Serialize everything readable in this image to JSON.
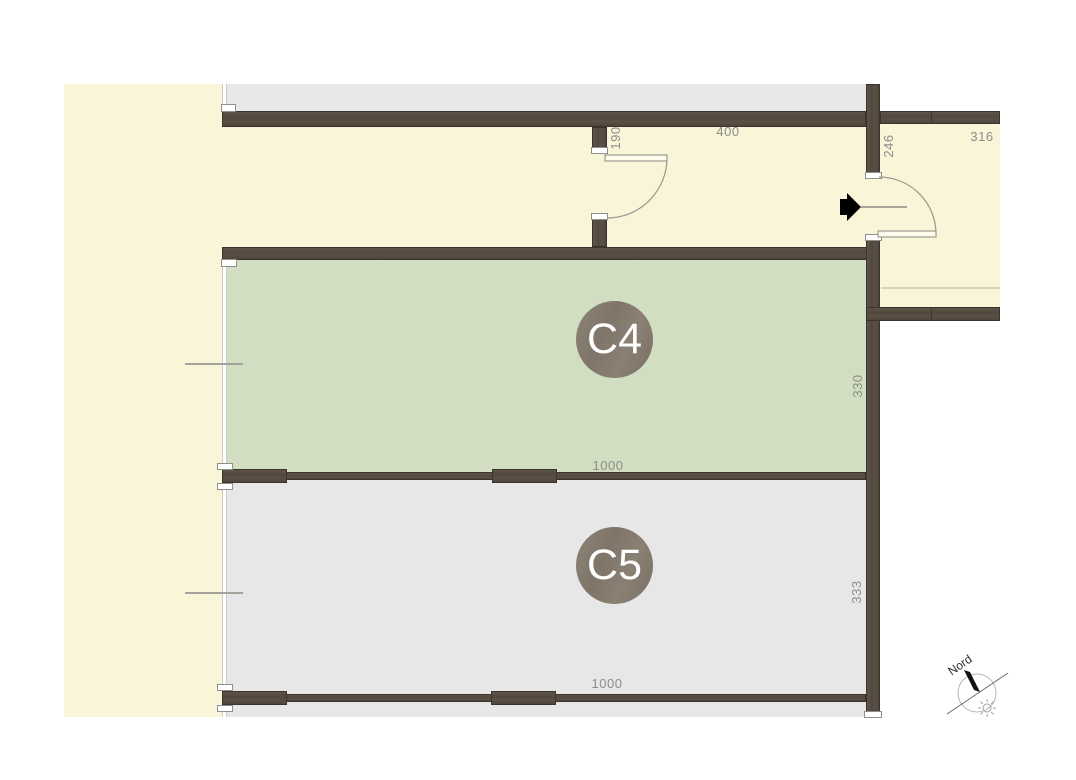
{
  "plan": {
    "type": "basement-floor-plan",
    "colors": {
      "wall": "#564b41",
      "floor_cream": "#f9f5d8",
      "floor_green": "#d2dec2",
      "floor_gray": "#e7e7e7",
      "badge": "#84796d",
      "dimension_text": "#8d8d88"
    }
  },
  "rooms": {
    "c4": {
      "label": "C4",
      "depth_cm": "330",
      "width_cm": "1000"
    },
    "c5": {
      "label": "C5",
      "depth_cm": "333",
      "width_cm": "1000"
    }
  },
  "dimensions": {
    "d190": "190",
    "d400": "400",
    "d246": "246",
    "d316": "316",
    "d330": "330",
    "d333": "333",
    "d1000_c4": "1000",
    "d1000_c5": "1000"
  },
  "compass": {
    "label": "Nord"
  },
  "icons": {
    "entrance_arrow": "entrance-arrow",
    "sun": "sun-icon",
    "north_needle": "compass-needle"
  }
}
